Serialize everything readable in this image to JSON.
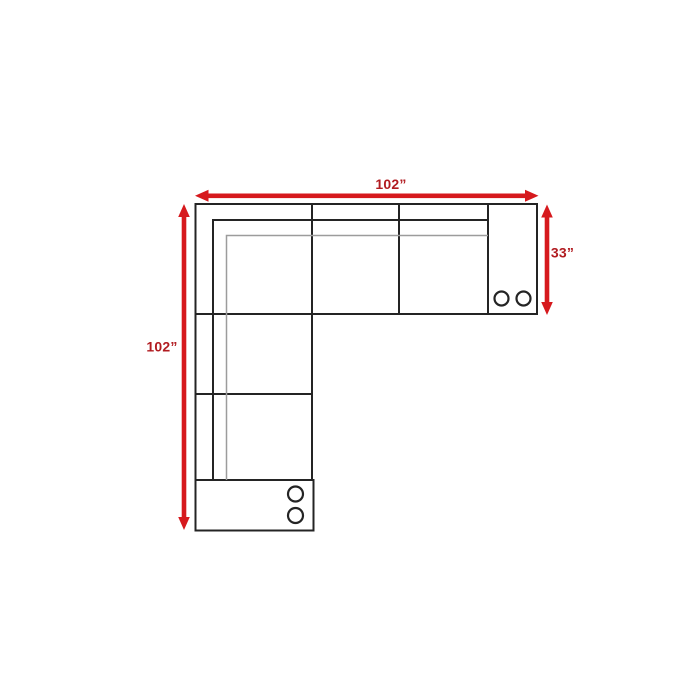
{
  "diagram": {
    "name": "Sectional sofa dimension plan (top view)",
    "background": "#ffffff",
    "colors": {
      "arrow": "#d6191d",
      "dimension_text": "#b11b20",
      "outline": "#242424",
      "outline_light": "#9c9c9c",
      "fill_white": "#ffffff"
    },
    "dimensions": {
      "top_width": {
        "label": "102”"
      },
      "left_height": {
        "label": "102”"
      },
      "right_depth": {
        "label": "33”"
      }
    },
    "features": {
      "right_console_cupholders": 2,
      "bottom_console_cupholders": 2,
      "top_row_seat_sections": 3,
      "left_leg_seat_sections": 2
    }
  }
}
